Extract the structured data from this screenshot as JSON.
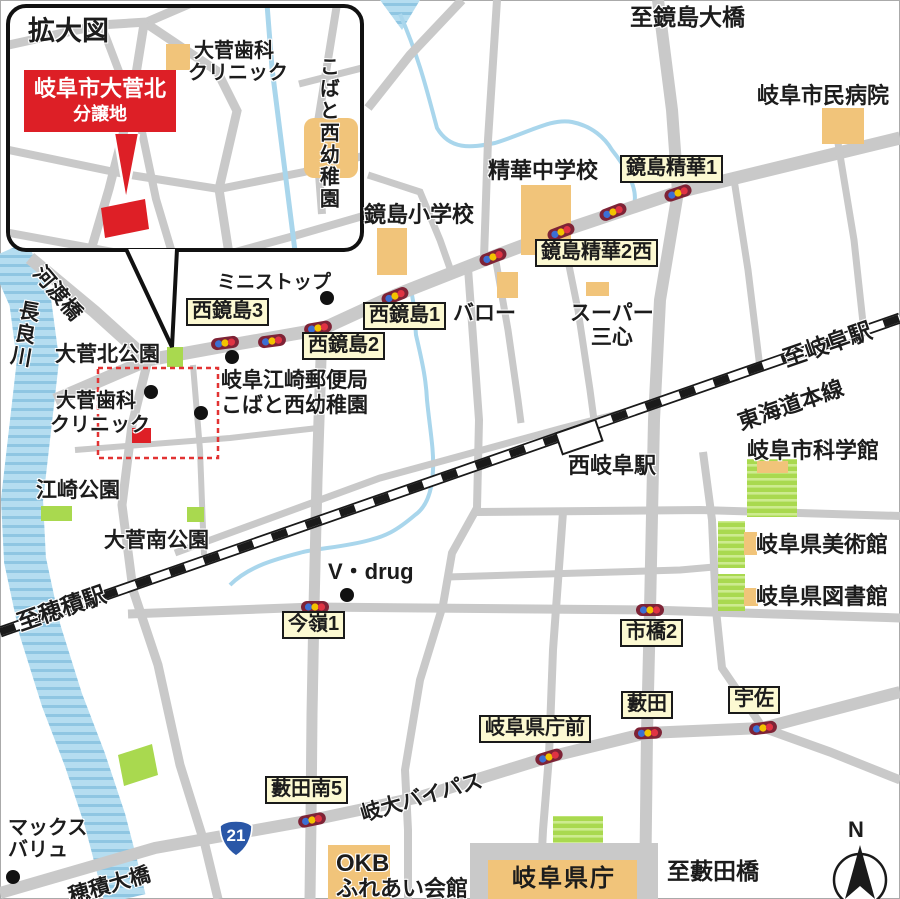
{
  "inset": {
    "title": "拡大図",
    "site_badge": {
      "line1": "岐阜市大菅北",
      "line2": "分譲地"
    },
    "dental_line1": "大菅歯科",
    "dental_line2": "クリニック",
    "kindergarten_vertical": "こばと西幼稚園"
  },
  "signal_labels": {
    "kagashima_seika1": "鏡島精華1",
    "kagashima_seika2w": "鏡島精華2西",
    "nishikagashima1": "西鏡島1",
    "nishikagashima2": "西鏡島2",
    "nishikagashima3": "西鏡島3",
    "imamine1": "今嶺1",
    "ichihashi2": "市橋2",
    "kencho_mae": "岐阜県庁前",
    "yabuta": "藪田",
    "usa": "宇佐",
    "yabuta_minami5": "藪田南5"
  },
  "places": {
    "to_kagashima_ohashi": "至鏡島大橋",
    "municipal_hospital": "岐阜市民病院",
    "seika_junior_high": "精華中学校",
    "kagashima_elementary": "鏡島小学校",
    "ministop": "ミニストップ",
    "valor": "バロー",
    "sankokoro_line1": "スーパー",
    "sankokoro_line2": "三心",
    "godo_bridge": "河渡橋",
    "nagara_river": "長良川",
    "osuga_kita_park": "大菅北公園",
    "dental_line1": "大菅歯科",
    "dental_line2": "クリニック",
    "esaki_post_office": "岐阜江崎郵便局",
    "kobato_kindergarten": "こばと西幼稚園",
    "to_gifu_station": "至岐阜駅",
    "tokaido_main_line": "東海道本線",
    "nishi_gifu_station": "西岐阜駅",
    "science_museum": "岐阜市科学館",
    "art_museum": "岐阜県美術館",
    "pref_library": "岐阜県図書館",
    "esaki_park": "江崎公園",
    "osuga_minami_park": "大菅南公園",
    "to_hozumi_station": "至穂積駅",
    "vdrug": "V・drug",
    "maxvalu_line1": "マックス",
    "maxvalu_line2": "バリュ",
    "hozumi_ohashi": "穂積大橋",
    "route21": "21",
    "gidai_bypass": "岐大バイパス",
    "okb_line1": "OKB",
    "okb_line2": "ふれあい会館",
    "pref_office": "岐阜県庁",
    "to_yabuta_bridge": "至藪田橋",
    "compass_north": "N"
  },
  "colors": {
    "site_red": "#dd1f26",
    "road_gray": "#c9c9c9",
    "water_blue": "#b5ddf0",
    "water_stripe": "#8fc6e2",
    "signal_label_bg": "#fcf9d2",
    "building_orange": "#f1c47a",
    "park_green": "#a9d94f",
    "route_sign_blue": "#2a57a7",
    "rail_black": "#1a1a1a"
  }
}
